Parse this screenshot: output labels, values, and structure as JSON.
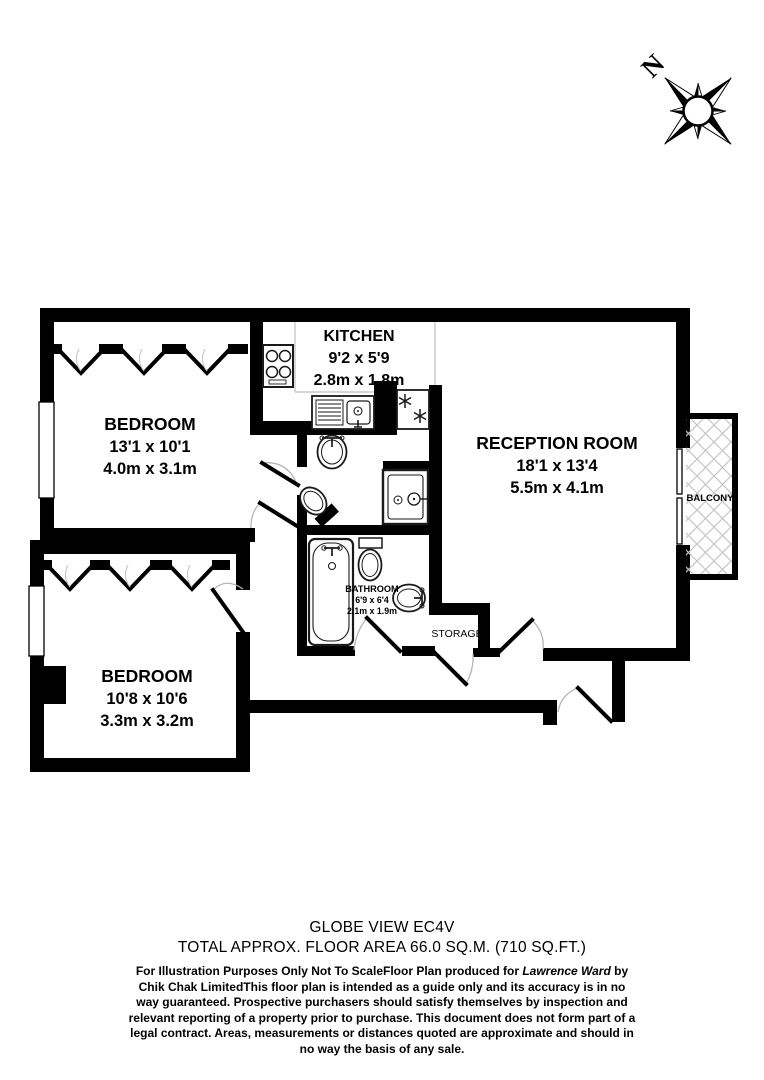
{
  "compass": {
    "north_label": "N"
  },
  "rooms": {
    "bedroom1": {
      "name": "BEDROOM",
      "imperial": "13'1 x 10'1",
      "metric": "4.0m x 3.1m"
    },
    "kitchen": {
      "name": "KITCHEN",
      "imperial": "9'2 x 5'9",
      "metric": "2.8m x 1.8m"
    },
    "reception": {
      "name": "RECEPTION ROOM",
      "imperial": "18'1 x 13'4",
      "metric": "5.5m x 4.1m"
    },
    "bedroom2": {
      "name": "BEDROOM",
      "imperial": "10'8 x 10'6",
      "metric": "3.3m x 3.2m"
    },
    "bathroom": {
      "name": "BATHROOM",
      "imperial": "6'9 x 6'4",
      "metric": "2.1m x 1.9m"
    },
    "storage": {
      "name": "STORAGE"
    },
    "balcony": {
      "name": "BALCONY"
    }
  },
  "footer": {
    "title": "GLOBE VIEW EC4V",
    "area": "TOTAL APPROX. FLOOR AREA 66.0 SQ.M. (710 SQ.FT.)",
    "disclaimer_before": "For Illustration Purposes Only Not To ScaleFloor Plan produced for ",
    "producer": "Lawrence Ward",
    "disclaimer_after": " by Chik Chak LimitedThis floor plan is intended as a guide only and its accuracy is in no way guaranteed. Prospective purchasers should satisfy themselves by inspection and relevant reporting of a property prior to purchase. This document does not form part of a legal contract. Areas, measurements or distances quoted are approximate and should in no way the basis of any sale."
  },
  "colors": {
    "walls": "#000000",
    "background": "#ffffff",
    "door_arc": "#b5b5b5",
    "balcony_hatch": "#c6c6c6",
    "counter_line": "#c9c9c9"
  },
  "icons": {
    "compass": "compass-rose-icon",
    "hob": "hob-icon",
    "sink": "sink-icon",
    "freezer": "snowflake-icon",
    "basin": "basin-icon",
    "toilet": "toilet-icon",
    "shower": "shower-icon",
    "bath": "bath-icon",
    "wardrobe": "wardrobe-zigzag-icon"
  }
}
